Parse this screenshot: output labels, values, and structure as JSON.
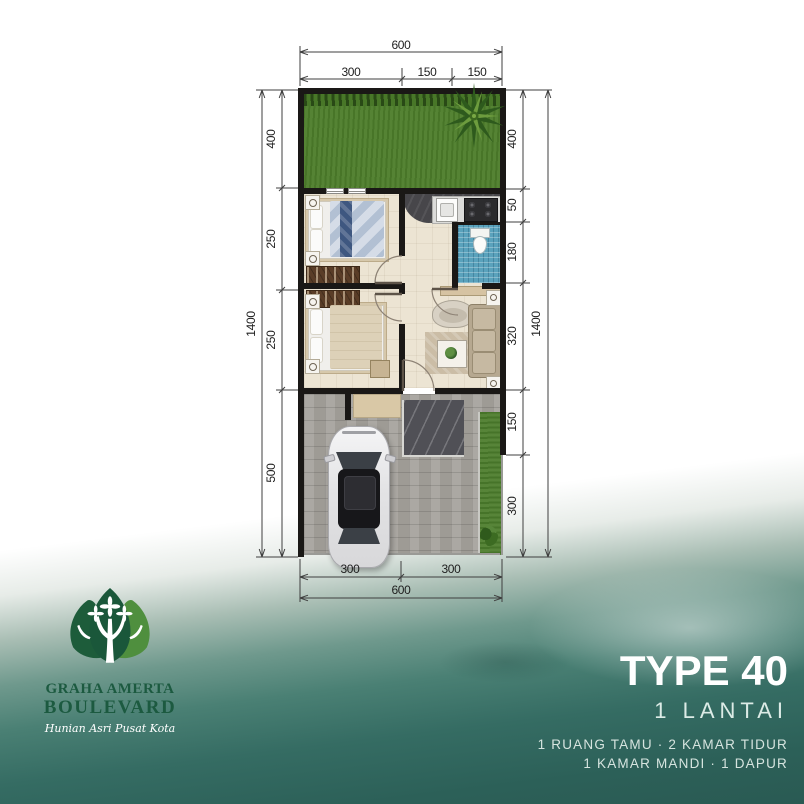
{
  "dims": {
    "top_total": "600",
    "top_segments": [
      "300",
      "150",
      "150"
    ],
    "left_total": "1400",
    "left_segments": [
      "400",
      "250",
      "250",
      "500"
    ],
    "right_total": "1400",
    "right_segments": [
      "400",
      "50",
      "180",
      "320",
      "150",
      "300"
    ],
    "bottom_total": "600",
    "bottom_segments": [
      "300",
      "300"
    ]
  },
  "branding": {
    "name_line1": "GRAHA AMERTA",
    "name_line2": "BOULEVARD",
    "tagline": "Hunian Asri Pusat Kota"
  },
  "info": {
    "type": "TYPE 40",
    "floors": "1 LANTAI",
    "features_line1": "1 RUANG TAMU · 2 KAMAR TIDUR",
    "features_line2": "1 KAMAR MANDI · 1 DAPUR"
  },
  "colors": {
    "brand_green": "#1c5a40",
    "teal_background": "#2a5a53",
    "lawn_green": "#4e7e2c",
    "bathroom_blue": "#5aa2bc",
    "wall_black": "#1a1816"
  }
}
